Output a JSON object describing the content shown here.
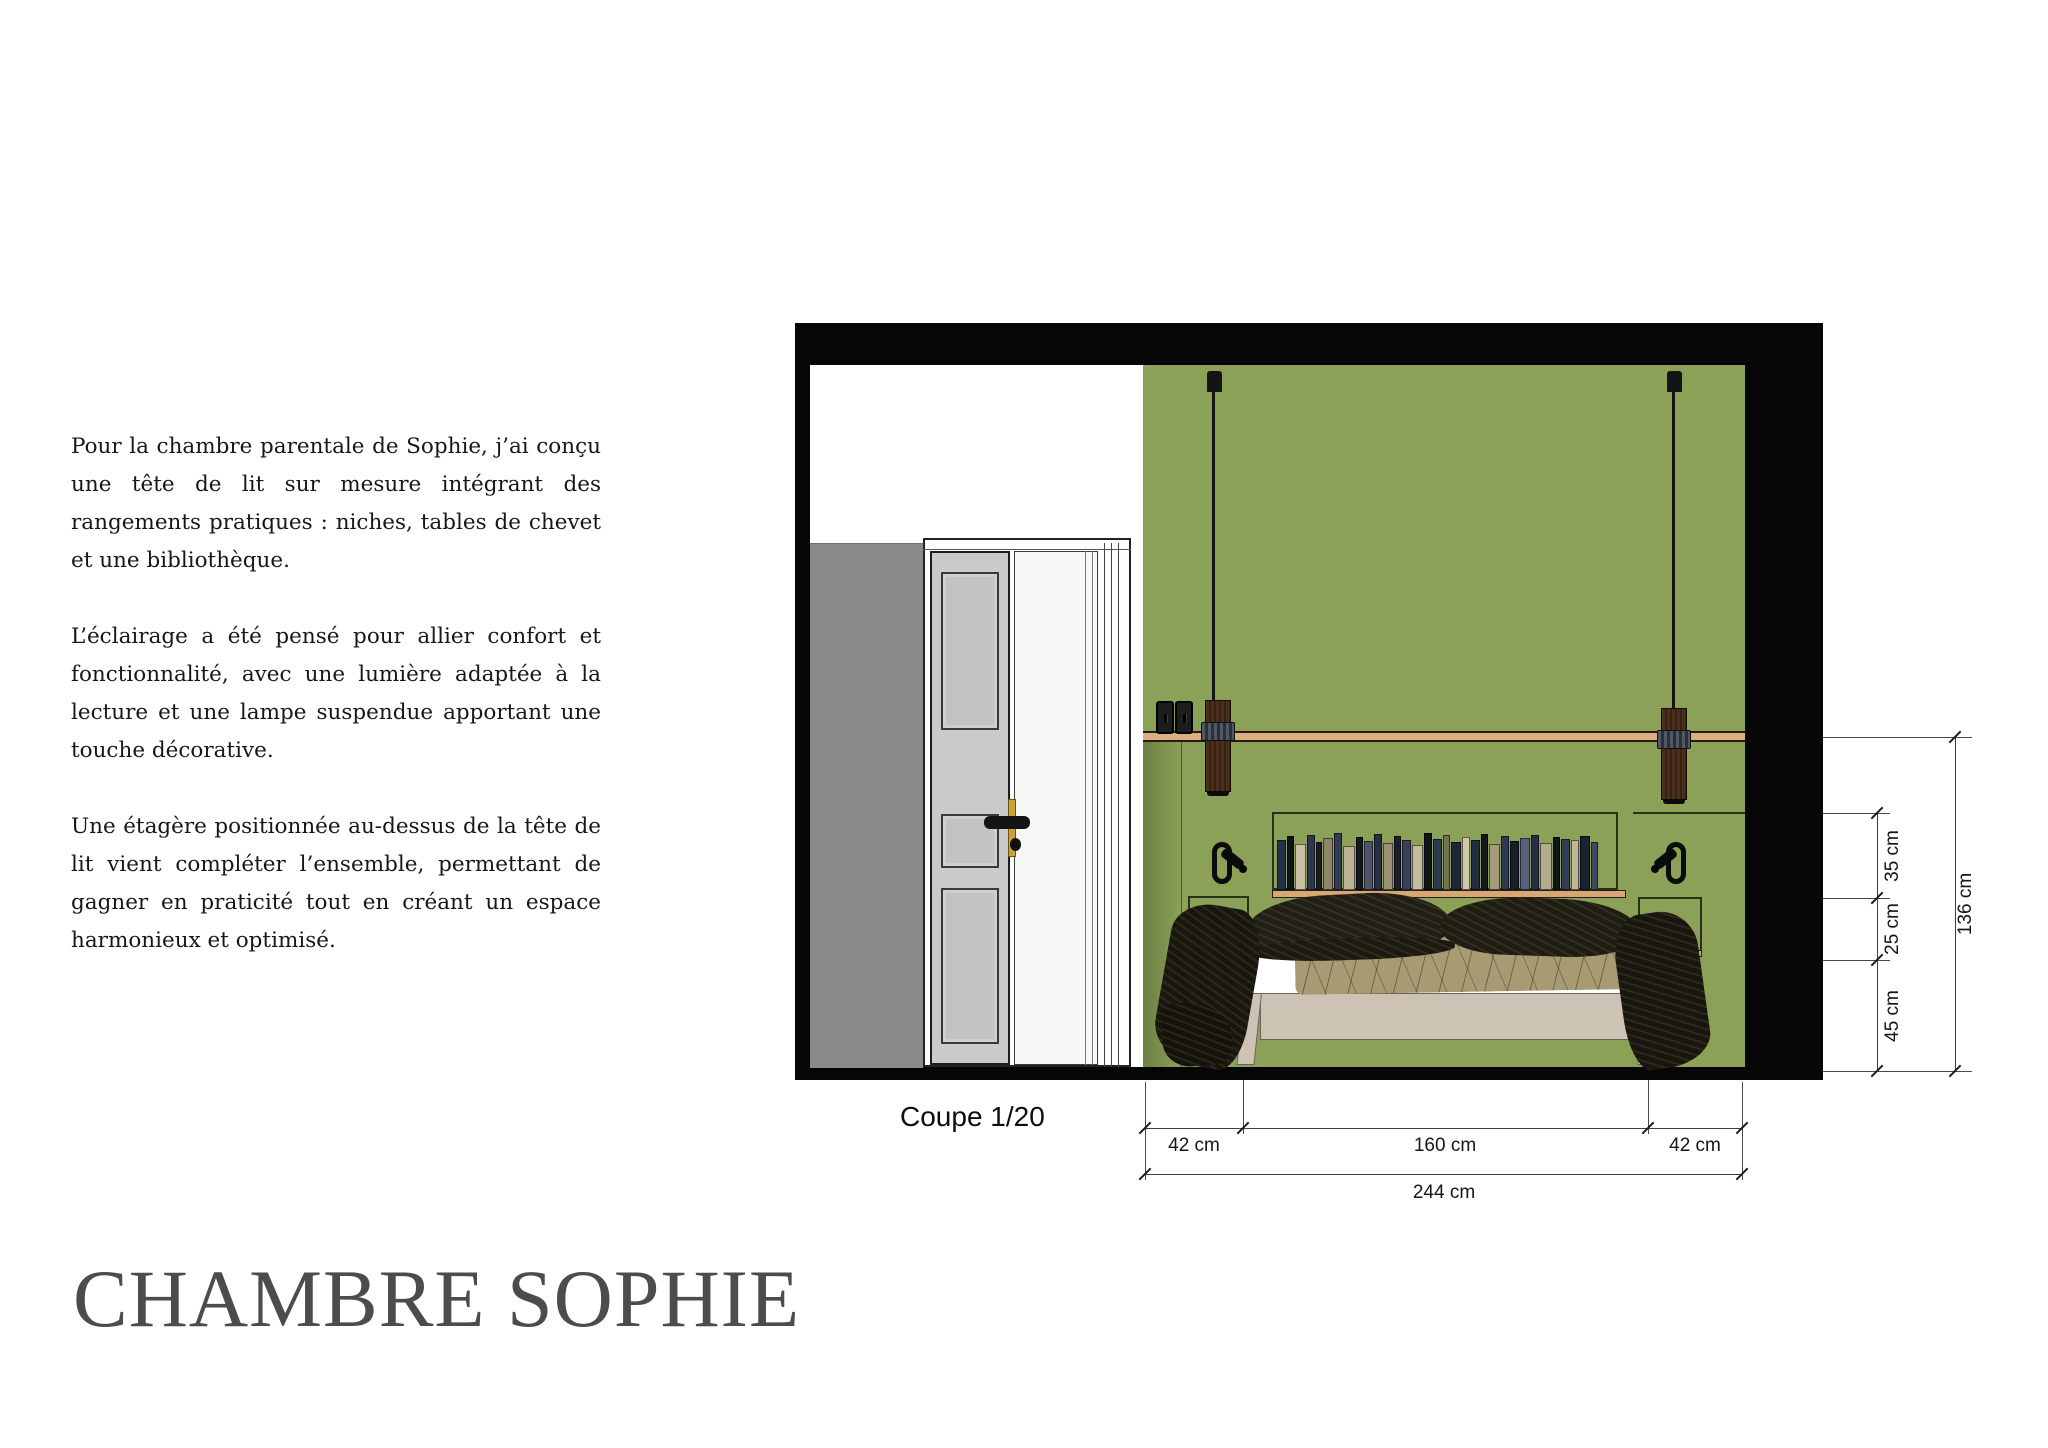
{
  "page": {
    "title": "CHAMBRE SOPHIE",
    "paragraphs": [
      "Pour la chambre parentale de Sophie, j’ai conçu une tête de lit sur mesure intégrant des rangements pratiques : niches, tables de chevet et une bibliothèque.",
      "L’éclairage a été pensé pour allier confort et fonctionnalité, avec une lumière adaptée à la lecture et une lampe suspendue apportant une touche décorative.",
      "Une étagère positionnée au-dessus de la tête de lit vient compléter l’ensemble, permettant de gagner en praticité tout en créant un espace harmonieux et optimisé."
    ]
  },
  "drawing": {
    "caption": "Coupe 1/20",
    "dimensions": {
      "bottom": {
        "segments": [
          "42 cm",
          "160 cm",
          "42 cm"
        ],
        "total": "244 cm"
      },
      "right": {
        "segments": [
          "35 cm",
          "25 cm",
          "45 cm"
        ],
        "total": "136 cm"
      }
    },
    "colors": {
      "wall_green": "#8BA158",
      "wall_gray": "#8A8A8A",
      "rail_wood": "#DCAE81",
      "shelf_wood": "#D7A876",
      "bed_base": "#CDC3B4",
      "throw_dark": "#18160F",
      "frame_black": "#060606",
      "title_gray": "#4C4C4C"
    },
    "books": [
      {
        "w": 9,
        "h": 50,
        "c": "#23304a"
      },
      {
        "w": 7,
        "h": 54,
        "c": "#101318"
      },
      {
        "w": 11,
        "h": 46,
        "c": "#c8bfa4"
      },
      {
        "w": 8,
        "h": 55,
        "c": "#2c3650"
      },
      {
        "w": 6,
        "h": 48,
        "c": "#191c22"
      },
      {
        "w": 10,
        "h": 52,
        "c": "#8e8467"
      },
      {
        "w": 8,
        "h": 57,
        "c": "#313b55"
      },
      {
        "w": 12,
        "h": 44,
        "c": "#bcb297"
      },
      {
        "w": 7,
        "h": 53,
        "c": "#14171d"
      },
      {
        "w": 9,
        "h": 49,
        "c": "#4d5569"
      },
      {
        "w": 8,
        "h": 56,
        "c": "#262f47"
      },
      {
        "w": 10,
        "h": 47,
        "c": "#9c9176"
      },
      {
        "w": 7,
        "h": 54,
        "c": "#1b1e26"
      },
      {
        "w": 9,
        "h": 50,
        "c": "#37415c"
      },
      {
        "w": 11,
        "h": 45,
        "c": "#c3baa0"
      },
      {
        "w": 8,
        "h": 57,
        "c": "#10131a"
      },
      {
        "w": 9,
        "h": 51,
        "c": "#2d374f"
      },
      {
        "w": 7,
        "h": 55,
        "c": "#776f55"
      },
      {
        "w": 10,
        "h": 48,
        "c": "#1f2737"
      },
      {
        "w": 8,
        "h": 53,
        "c": "#cfc6ab"
      },
      {
        "w": 9,
        "h": 50,
        "c": "#222b41"
      },
      {
        "w": 7,
        "h": 56,
        "c": "#15181f"
      },
      {
        "w": 11,
        "h": 46,
        "c": "#a59a7d"
      },
      {
        "w": 8,
        "h": 54,
        "c": "#2f3952"
      },
      {
        "w": 9,
        "h": 49,
        "c": "#191d25"
      },
      {
        "w": 10,
        "h": 52,
        "c": "#56607a"
      },
      {
        "w": 8,
        "h": 55,
        "c": "#262e44"
      },
      {
        "w": 12,
        "h": 47,
        "c": "#b4aa8e"
      },
      {
        "w": 7,
        "h": 53,
        "c": "#11141b"
      },
      {
        "w": 9,
        "h": 51,
        "c": "#333d58"
      },
      {
        "w": 8,
        "h": 50,
        "c": "#c0b69a"
      },
      {
        "w": 10,
        "h": 54,
        "c": "#1a222f"
      },
      {
        "w": 7,
        "h": 48,
        "c": "#3e4966"
      }
    ]
  }
}
